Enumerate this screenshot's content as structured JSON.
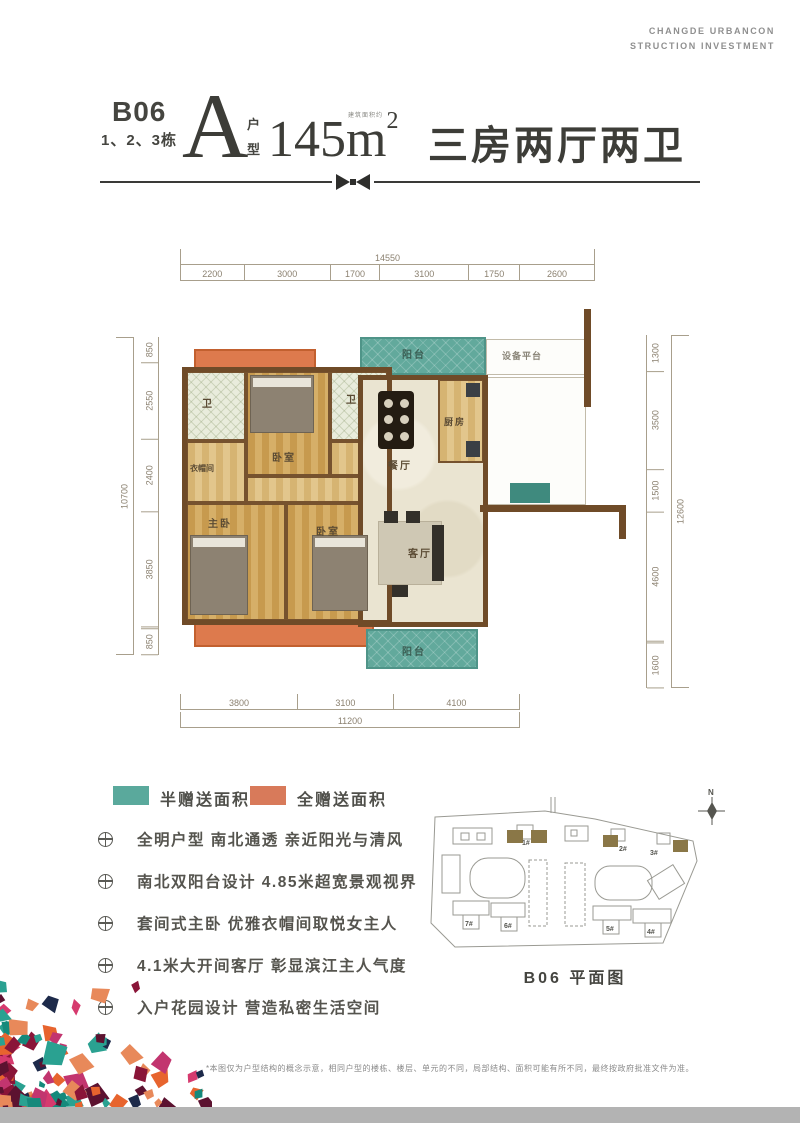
{
  "brand": {
    "line1": "CHANGDE URBANCON",
    "line2": "STRUCTION INVESTMENT"
  },
  "header": {
    "block": "B06",
    "buildings": "1、2、3栋",
    "unit_letter": "A",
    "unit_word_top": "户",
    "unit_word_bottom": "型",
    "area_number": "145",
    "area_unit": "m",
    "area_sup": "2",
    "area_note": "建筑面积约",
    "layout_title": "三房两厅两卫"
  },
  "plan": {
    "rooms": {
      "balcony_top": "阳台",
      "equipment": "设备平台",
      "bath1": "卫",
      "bedroom_top": "卧室",
      "bath2": "卫",
      "kitchen": "厨房",
      "dining": "餐厅",
      "cloak": "衣帽间",
      "master": "主卧",
      "bedroom2": "卧室",
      "living": "客厅",
      "balcony_bottom": "阳台"
    },
    "dims_top": {
      "total": "14550",
      "segments": [
        "2200",
        "3000",
        "1700",
        "3100",
        "1750",
        "2600"
      ]
    },
    "dims_left": {
      "total": "10700",
      "segments": [
        "850",
        "2550",
        "2400",
        "3850",
        "850"
      ]
    },
    "dims_right": {
      "total": "12600",
      "segments": [
        "1300",
        "3500",
        "1500",
        "4600",
        "1600"
      ]
    },
    "dims_bottom": {
      "total": "11200",
      "segments": [
        "3800",
        "3100",
        "4100"
      ]
    }
  },
  "legend": {
    "half": {
      "label": "半赠送面积",
      "color": "#5aa99c"
    },
    "full": {
      "label": "全赠送面积",
      "color": "#d87a5a"
    }
  },
  "features": [
    "全明户型  南北通透  亲近阳光与清风",
    "南北双阳台设计  4.85米超宽景观视界",
    "套间式主卧  优雅衣帽间取悦女主人",
    "4.1米大开间客厅  彰显滨江主人气度",
    "入户花园设计  营造私密生活空间"
  ],
  "sitemap": {
    "caption": "B06  平面图",
    "compass": "N",
    "buildings": [
      "1#",
      "2#",
      "3#",
      "7#",
      "6#",
      "5#",
      "4#"
    ],
    "highlight_color": "#8a7747"
  },
  "disclaimer": "*本图仅为户型结构的概念示意，相同户型的楼栋、楼层、单元的不同，局部结构、面积可能有所不同，最终按政府批准文件为准。",
  "decor": {
    "mosaic_palette": [
      "#d63a6e",
      "#15897b",
      "#e8895a",
      "#1d2a4a",
      "#8a1538",
      "#2aa191",
      "#c2356f",
      "#e7642e",
      "#5c1230"
    ],
    "bottom_bar_color": "#b3b3b3"
  }
}
